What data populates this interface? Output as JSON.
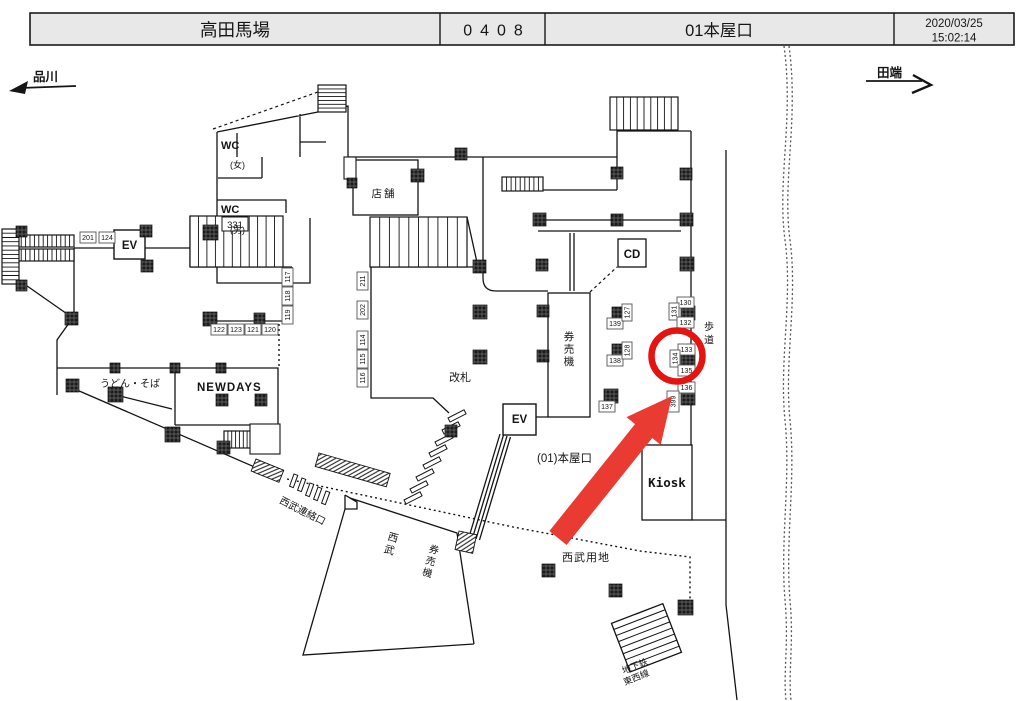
{
  "header": {
    "station_name": "高田馬場",
    "station_code": "0408",
    "location_name": "01本屋口",
    "date": "2020/03/25",
    "time": "15:02:14"
  },
  "directions": {
    "left_label": "品川",
    "right_label": "田端"
  },
  "plan_labels": {
    "wc_women_line1": "WC",
    "wc_women_line2": "(女)",
    "wc_men_line1": "WC",
    "wc_men_line2": "(男)",
    "stair_331": "331",
    "elevator_west": "EV",
    "shop": "店舗",
    "cd_machine": "CD",
    "ticket_machines": "券売機",
    "ticket_gate": "改札",
    "elevator_center": "EV",
    "exit_label": "(01)本屋口",
    "kiosk": "Kiosk",
    "udon_soba": "うどん・そば",
    "newdays": "NEWDAYS",
    "seibu_connection": "西武連絡口",
    "seibu": "西武",
    "seibu_ticket_machines": "券売機",
    "seibu_property": "西武用地",
    "sidewalk": "歩道",
    "subway_line1": "地下鉄",
    "subway_line2": "東西線"
  },
  "camera_labels": [
    "201",
    "124",
    "122",
    "123",
    "121",
    "120",
    "117",
    "118",
    "119",
    "211",
    "202",
    "114",
    "115",
    "116",
    "139",
    "127",
    "138",
    "128",
    "137",
    "130",
    "131",
    "132",
    "133",
    "134",
    "135",
    "136",
    "399"
  ],
  "annotations": {
    "circle_color": "#e51410",
    "arrow_color": "#ea3b33"
  }
}
